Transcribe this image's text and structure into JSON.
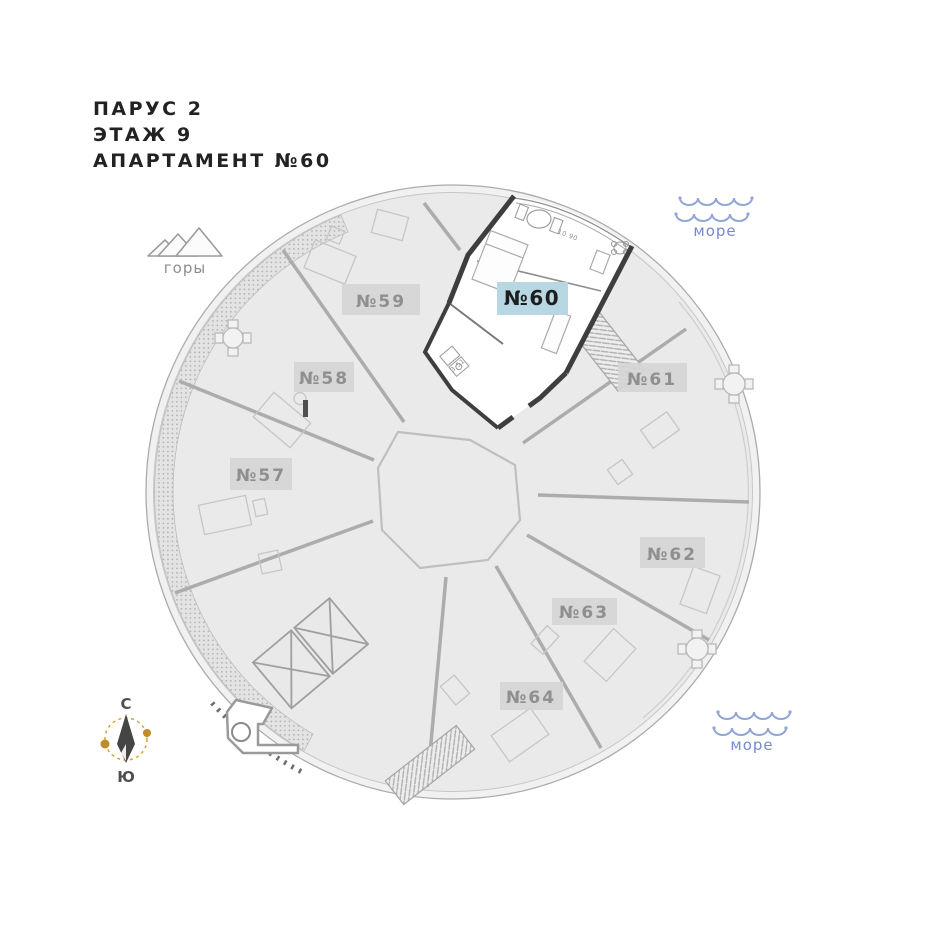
{
  "title": {
    "line1": "ПАРУС 2",
    "line2": "ЭТАЖ 9",
    "line3": "АПАРТАМЕНТ №60"
  },
  "legend": {
    "mountains_label": "горы",
    "sea_label_top": "море",
    "sea_label_bottom": "море",
    "wave_color": "#92a5d6",
    "sea_text_color": "#7589cc",
    "mountain_color": "#9c9c9c"
  },
  "compass": {
    "north_label": "С",
    "south_label": "Ю",
    "ring_color": "#d9a43a",
    "needle_color": "#454545"
  },
  "plan": {
    "highlighted_apartment": {
      "number": "№60",
      "label_bg": "#b7d7e3",
      "label_text_color": "#1d1d1d",
      "area_terrace": "10.90",
      "area_bathroom": "3.51"
    },
    "apartments": [
      {
        "number": "№57"
      },
      {
        "number": "№58"
      },
      {
        "number": "№59"
      },
      {
        "number": "№61"
      },
      {
        "number": "№62"
      },
      {
        "number": "№63"
      },
      {
        "number": "№64"
      }
    ],
    "label_bg": "#d5d5d5",
    "label_text_color": "#8f8f8f"
  }
}
